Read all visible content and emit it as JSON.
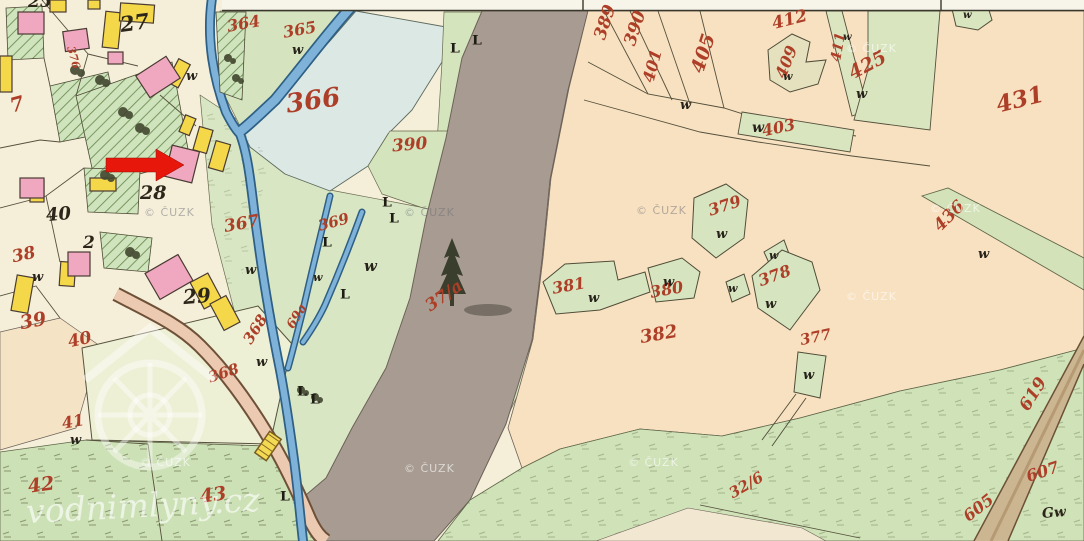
{
  "map": {
    "description": "historical hand-coloured cadastral map sheet",
    "watermarks": {
      "cuzk": "© ČUZK",
      "brand": "vodnimlyny.cz"
    },
    "symbols": {
      "meadow_letter": "w",
      "meadow_sign": "L"
    },
    "marker": {
      "shape": "red-arrow-right",
      "color": "#e8170b"
    },
    "houses": {
      "h25": "25",
      "h27": "27",
      "h28": "28",
      "h29": "29",
      "h40": "40",
      "h2": "2",
      "gw": "Gw"
    },
    "parcels": {
      "p7": "7",
      "p376": "376",
      "p364": "364",
      "p365": "365",
      "p366": "366",
      "p390_left": "390",
      "p367": "367",
      "p369": "369",
      "p368_diag": "368",
      "p369a": "69a",
      "p368_road": "368",
      "p37a": "37/a",
      "p32_6": "32/6",
      "p389": "389",
      "p390_right": "390",
      "p401": "401",
      "p405": "405",
      "p412": "412",
      "p409": "409",
      "p411": "411",
      "p425": "425",
      "p403": "403",
      "p431": "431",
      "p436": "436",
      "p379": "379",
      "p380": "380",
      "p378": "378",
      "p381": "381",
      "p382": "382",
      "p377": "377",
      "p619": "619",
      "p607": "607",
      "p605": "605",
      "p38": "38",
      "p39": "39",
      "p40": "40",
      "p41": "41",
      "p42": "42",
      "p43": "43"
    },
    "colors": {
      "paper": "#f5efda",
      "meadow_green": "#d8e6c3",
      "pond_blue": "#dce8e4",
      "forest_gray": "#a89c92",
      "field_peach": "#f8e1c1",
      "bottom_green": "#cfe2b8",
      "building_pink": "#f0a8c0",
      "building_yellow": "#f4d84a",
      "stream_blue": "#7fb2d8",
      "road_tan": "#ccb692",
      "ink_red": "#ad3f28",
      "ink_black": "#2b2619"
    }
  }
}
